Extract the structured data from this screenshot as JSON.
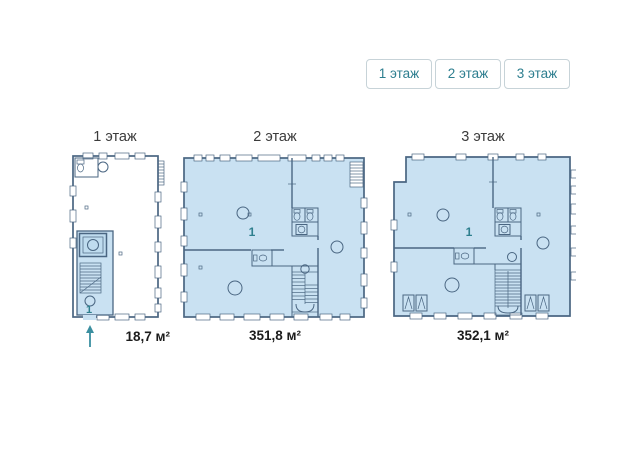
{
  "floor_switcher": {
    "buttons": [
      {
        "label": "1 этаж"
      },
      {
        "label": "2 этаж"
      },
      {
        "label": "3 этаж"
      }
    ]
  },
  "plans": [
    {
      "title": "1 этаж",
      "area": "18,7 м²",
      "unit_label": "1"
    },
    {
      "title": "2 этаж",
      "area": "351,8 м²",
      "unit_label": "1"
    },
    {
      "title": "3 этаж",
      "area": "352,1 м²",
      "unit_label": "1"
    }
  ],
  "icons": {
    "entrance_arrow": "up-arrow"
  },
  "colors": {
    "accent_teal": "#2e7f8e",
    "arrow_teal": "#3b8fa0",
    "plan_fill": "#c9e1f2",
    "plan_subroom_fill": "#bfdcef",
    "plan_line": "#4a6682",
    "button_border": "#c7d3d8",
    "title_text": "#3b3b3b",
    "area_text": "#1c1c1c"
  }
}
